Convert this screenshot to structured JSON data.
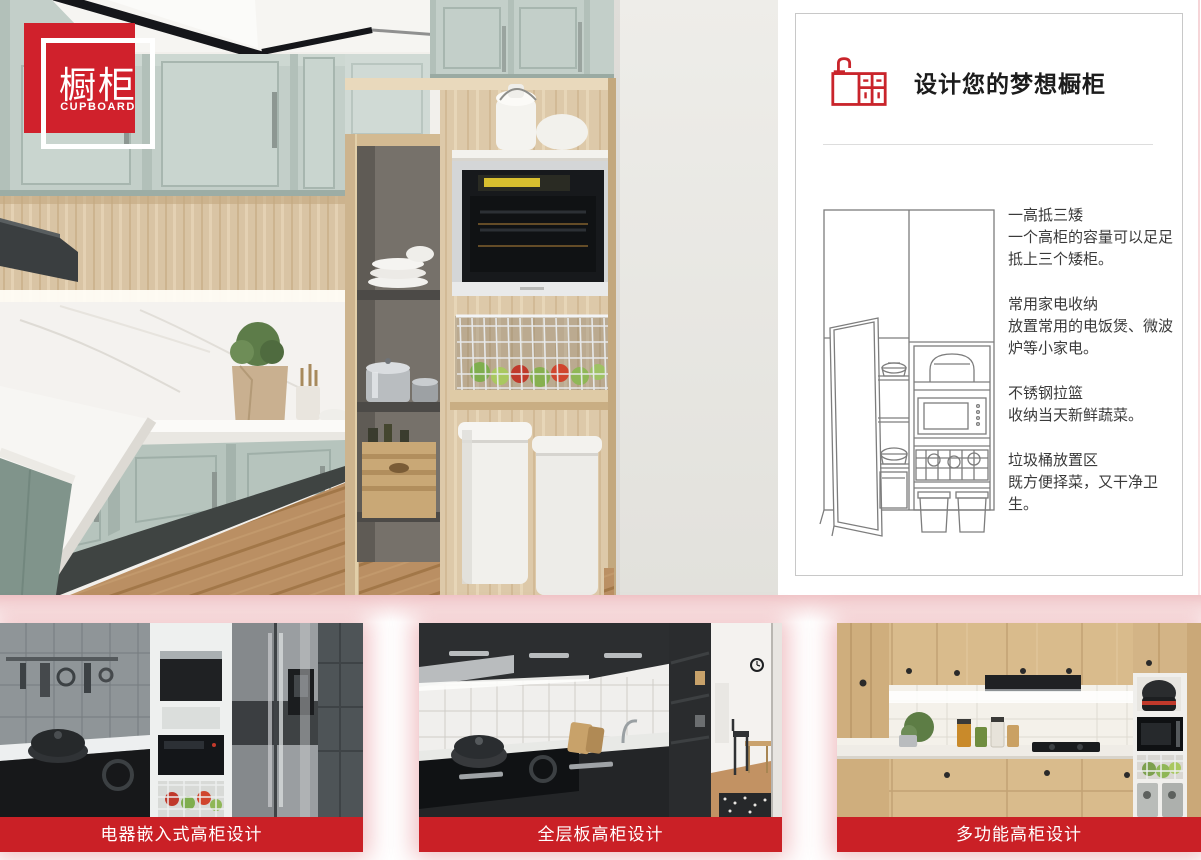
{
  "badge": {
    "title_cn": "橱柜",
    "title_en": "CUPBOARD",
    "color": "#d0212c"
  },
  "panel": {
    "icon": "cabinet-sink-icon",
    "title": "设计您的梦想橱柜",
    "illustration": "tall-cabinet-line-drawing",
    "features": [
      {
        "title": "一高抵三矮",
        "desc": "一个高柜的容量可以足足抵上三个矮柜。"
      },
      {
        "title": "常用家电收纳",
        "desc": "放置常用的电饭煲、微波炉等小家电。"
      },
      {
        "title": "不锈钢拉篮",
        "desc": "收纳当天新鲜蔬菜。"
      },
      {
        "title": "垃圾桶放置区",
        "desc": "既方便择菜，又干净卫生。"
      }
    ]
  },
  "hero": {
    "image": "kitchen-photo"
  },
  "gallery": {
    "cards": [
      {
        "caption": "电器嵌入式高柜设计",
        "image": "appliance-embedded-tall-cabinet-photo"
      },
      {
        "caption": "全层板高柜设计",
        "image": "full-shelf-tall-cabinet-photo"
      },
      {
        "caption": "多功能高柜设计",
        "image": "multifunction-tall-cabinet-photo"
      }
    ]
  },
  "colors": {
    "accent_red": "#ca2026",
    "badge_red": "#d0212c",
    "sage_green": "#c3cfc9",
    "wood": "#d8c3a3",
    "panel_border": "#c8c8c8"
  }
}
